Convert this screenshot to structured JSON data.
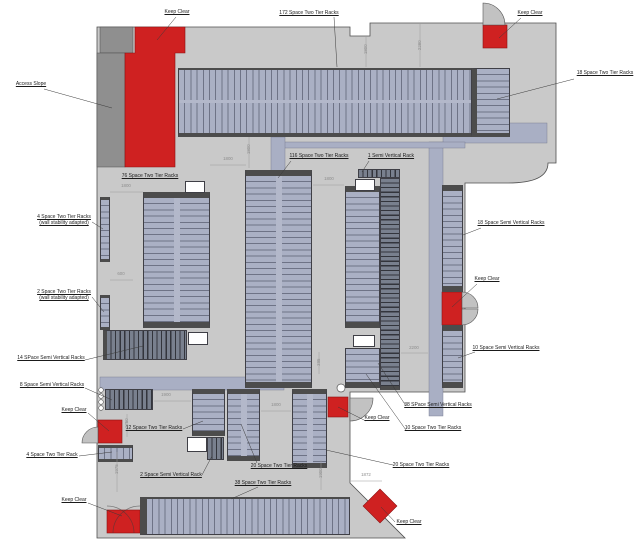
{
  "drawing_title": "",
  "colors": {
    "floor": "#c9c9c9",
    "access_slope": "#8f8f8f",
    "rack_light": "#aab0c4",
    "rack_light_line": "#6e7386",
    "rack_dark": "#79808e",
    "rack_dark_line": "#33353c",
    "rack_cap": "#4c4c4c",
    "keep_clear_red": "#cf2121",
    "outline": "#4f4f4f",
    "dimension_gray": "#8e8e8e"
  },
  "labels": [
    {
      "id": "keep-clear-top-left",
      "text": "Keep Clear",
      "x": 156,
      "y": 9,
      "w": 42,
      "leader": [
        176,
        17,
        157,
        40
      ]
    },
    {
      "id": "label-172-space-two-tier-racks",
      "text": "172 Space Two Tier Racks",
      "x": 266,
      "y": 10,
      "w": 86,
      "leader": [
        334,
        17,
        337,
        67
      ]
    },
    {
      "id": "keep-clear-top-right",
      "text": "Keep Clear",
      "x": 509,
      "y": 10,
      "w": 42,
      "leader": [
        521,
        18,
        499,
        38
      ]
    },
    {
      "id": "access-slope",
      "text": "Access Slope",
      "x": 8,
      "y": 81,
      "w": 46,
      "leader": [
        44,
        89,
        112,
        108
      ]
    },
    {
      "id": "label-18-space-two-tier-racks",
      "text": "18 Space Two Tier Racks",
      "x": 570,
      "y": 70,
      "w": 70,
      "leader": [
        574,
        79,
        497,
        99
      ]
    },
    {
      "id": "label-76-space-two-tier-racks",
      "text": "76 Space Two Tier Racks",
      "x": 118,
      "y": 173,
      "w": 64,
      "leader": null
    },
    {
      "id": "label-116-space-two-tier-racks",
      "text": "116 Space Two Tier Racks",
      "x": 286,
      "y": 153,
      "w": 66,
      "leader": [
        291,
        161,
        278,
        178
      ]
    },
    {
      "id": "label-1-semi-vertical-rack",
      "text": "1 Semi Vertical Rack",
      "x": 362,
      "y": 153,
      "w": 58,
      "leader": [
        369,
        161,
        362,
        172
      ]
    },
    {
      "id": "label-4-space-wall-adapted",
      "text": "4 Space Two Tier Racks\n(wall stability adapted)",
      "x": 36,
      "y": 214,
      "w": 56,
      "leader": [
        92,
        222,
        103,
        229
      ]
    },
    {
      "id": "label-2-space-wall-adapted",
      "text": "2 Space Two Tier Racks\n(wall stability adapted)",
      "x": 36,
      "y": 289,
      "w": 56,
      "leader": [
        92,
        297,
        104,
        312
      ]
    },
    {
      "id": "label-18-space-semi-vertical-racks",
      "text": "18 Space Semi Vertical Racks",
      "x": 476,
      "y": 220,
      "w": 70,
      "leader": [
        481,
        228,
        463,
        235
      ]
    },
    {
      "id": "keep-clear-right",
      "text": "Keep Clear",
      "x": 467,
      "y": 276,
      "w": 40,
      "leader": [
        477,
        284,
        452,
        307
      ]
    },
    {
      "id": "label-10-space-semi-vertical-racks",
      "text": "10 Space Semi Vertical Racks",
      "x": 470,
      "y": 345,
      "w": 72,
      "leader": [
        475,
        352,
        458,
        358
      ]
    },
    {
      "id": "label-14-space-semi-vertical-racks",
      "text": "14 SPace Semi Vertical Racks",
      "x": 16,
      "y": 355,
      "w": 70,
      "leader": [
        85,
        360,
        143,
        346
      ]
    },
    {
      "id": "label-8-space-semi-vertical-racks",
      "text": "8 Space Semi Vertical Racks",
      "x": 18,
      "y": 382,
      "w": 68,
      "leader": [
        85,
        388,
        112,
        400
      ]
    },
    {
      "id": "keep-clear-left",
      "text": "Keep Clear",
      "x": 56,
      "y": 407,
      "w": 36,
      "leader": [
        88,
        413,
        109,
        431
      ]
    },
    {
      "id": "label-12-space-two-tier-racks",
      "text": "12 Space Two Tier Racks",
      "x": 124,
      "y": 425,
      "w": 60,
      "leader": [
        183,
        429,
        203,
        421
      ]
    },
    {
      "id": "label-4-space-two-tier-rack",
      "text": "4 Space Two Tier Rack",
      "x": 24,
      "y": 452,
      "w": 56,
      "leader": [
        79,
        456,
        112,
        452
      ]
    },
    {
      "id": "label-2-space-semi-vertical-rack",
      "text": "2 Space Semi Vertical Rack",
      "x": 138,
      "y": 472,
      "w": 66,
      "leader": [
        202,
        475,
        212,
        456
      ]
    },
    {
      "id": "keep-clear-bottom-left",
      "text": "Keep Clear",
      "x": 56,
      "y": 497,
      "w": 36,
      "leader": [
        88,
        503,
        122,
        516
      ]
    },
    {
      "id": "label-38-space-two-tier-racks",
      "text": "38 Space Two Tier Racks",
      "x": 232,
      "y": 480,
      "w": 62,
      "leader": [
        258,
        487,
        231,
        499
      ]
    },
    {
      "id": "label-20-space-two-tier-racks-a",
      "text": "20 Space Two Tier Racks",
      "x": 249,
      "y": 463,
      "w": 60,
      "leader": [
        257,
        463,
        241,
        424
      ]
    },
    {
      "id": "label-20-space-two-tier-racks-b",
      "text": "20 Space Two Tier Racks",
      "x": 391,
      "y": 462,
      "w": 60,
      "leader": [
        393,
        465,
        326,
        450
      ]
    },
    {
      "id": "label-10-space-two-tier-racks",
      "text": "10 Space Two Tier Racks",
      "x": 402,
      "y": 425,
      "w": 62,
      "leader": [
        406,
        430,
        366,
        374
      ]
    },
    {
      "id": "label-38-space-semi-vertical-racks",
      "text": "38 SPace Semi Vertical Racks",
      "x": 402,
      "y": 402,
      "w": 72,
      "leader": [
        406,
        406,
        378,
        363
      ]
    },
    {
      "id": "keep-clear-mid",
      "text": "Keep Clear",
      "x": 359,
      "y": 415,
      "w": 36,
      "leader": [
        366,
        421,
        338,
        407
      ]
    },
    {
      "id": "keep-clear-bottom-right",
      "text": "Keep Clear",
      "x": 391,
      "y": 519,
      "w": 36,
      "leader": [
        395,
        522,
        381,
        507
      ]
    }
  ],
  "dimensions": [
    {
      "text": "1800",
      "cx": 228,
      "cy": 160,
      "rot": false,
      "line": [
        210,
        165,
        246,
        165
      ]
    },
    {
      "text": "1800",
      "cx": 249,
      "cy": 150,
      "rot": true,
      "line": [
        249,
        137,
        249,
        168
      ]
    },
    {
      "text": "1800",
      "cx": 366,
      "cy": 50,
      "rot": true,
      "line": [
        366,
        36,
        366,
        67
      ]
    },
    {
      "text": "2280",
      "cx": 420,
      "cy": 46,
      "rot": true,
      "line": [
        420,
        24,
        420,
        67
      ]
    },
    {
      "text": "1800",
      "cx": 126,
      "cy": 187,
      "rot": false,
      "line": [
        110,
        192,
        143,
        192
      ]
    },
    {
      "text": "1800",
      "cx": 329,
      "cy": 180,
      "rot": false,
      "line": [
        313,
        185,
        344,
        185
      ]
    },
    {
      "text": "600",
      "cx": 121,
      "cy": 275,
      "rot": false,
      "line": [
        110,
        280,
        133,
        280
      ]
    },
    {
      "text": "2200",
      "cx": 414,
      "cy": 349,
      "rot": false,
      "line": [
        401,
        353,
        428,
        353
      ]
    },
    {
      "text": "1900",
      "cx": 166,
      "cy": 396,
      "rot": false,
      "line": [
        154,
        401,
        191,
        401
      ]
    },
    {
      "text": "1800",
      "cx": 276,
      "cy": 406,
      "rot": false,
      "line": [
        261,
        411,
        291,
        411
      ]
    },
    {
      "text": "1750",
      "cx": 127,
      "cy": 424,
      "rot": true,
      "line": [
        127,
        414,
        127,
        437
      ]
    },
    {
      "text": "1975",
      "cx": 117,
      "cy": 470,
      "rot": true,
      "line": [
        117,
        452,
        117,
        492
      ]
    },
    {
      "text": "1872",
      "cx": 366,
      "cy": 476,
      "rot": false,
      "line": [
        351,
        481,
        382,
        481
      ]
    },
    {
      "text": "1900",
      "cx": 321,
      "cy": 474,
      "rot": true,
      "line": [
        321,
        460,
        321,
        490
      ]
    },
    {
      "text": "395",
      "cx": 319,
      "cy": 363,
      "rot": true,
      "line": [
        319,
        352,
        319,
        374
      ]
    }
  ],
  "racks": [
    {
      "id": "rack-172-space-two-tier",
      "x": 178,
      "y": 68,
      "w": 294,
      "h": 69,
      "kind": "v",
      "cap": {
        "t": 2,
        "b": 4
      },
      "div": "h"
    },
    {
      "id": "rack-18-space-two-tier",
      "x": 472,
      "y": 68,
      "w": 38,
      "h": 69,
      "kind": "h",
      "cap": {
        "l": 5,
        "b": 4
      }
    },
    {
      "id": "rack-76-space-two-tier",
      "x": 143,
      "y": 192,
      "w": 67,
      "h": 136,
      "kind": "h",
      "cap": {
        "t": 6,
        "b": 6
      },
      "div": "v"
    },
    {
      "id": "rack-4-space-wall",
      "x": 100,
      "y": 197,
      "w": 10,
      "h": 65,
      "kind": "h",
      "cap": {
        "t": 3,
        "b": 3
      }
    },
    {
      "id": "rack-2-space-wall",
      "x": 100,
      "y": 295,
      "w": 10,
      "h": 35,
      "kind": "h",
      "cap": {
        "t": 3,
        "b": 3
      }
    },
    {
      "id": "rack-14-space-semi-vertical",
      "x": 103,
      "y": 330,
      "w": 84,
      "h": 30,
      "kind": "vd",
      "cap": {
        "l": 4
      }
    },
    {
      "id": "rack-116-space-two-tier",
      "x": 245,
      "y": 170,
      "w": 67,
      "h": 218,
      "kind": "h",
      "cap": {
        "t": 6,
        "b": 6
      },
      "div": "v"
    },
    {
      "id": "rack-1-semi-vertical",
      "x": 358,
      "y": 169,
      "w": 42,
      "h": 9,
      "kind": "vd",
      "cap": {}
    },
    {
      "id": "rack-38-space-semi-vertical",
      "x": 380,
      "y": 178,
      "w": 20,
      "h": 212,
      "kind": "hd",
      "cap": {
        "b": 4
      }
    },
    {
      "id": "rack-center-two-tier",
      "x": 345,
      "y": 186,
      "w": 35,
      "h": 142,
      "kind": "h",
      "cap": {
        "t": 6,
        "b": 6
      }
    },
    {
      "id": "rack-10-space-two-tier",
      "x": 345,
      "y": 348,
      "w": 35,
      "h": 40,
      "kind": "h",
      "cap": {
        "b": 6
      }
    },
    {
      "id": "rack-18-space-semi-vertical",
      "x": 442,
      "y": 185,
      "w": 21,
      "h": 107,
      "kind": "h",
      "cap": {
        "t": 6,
        "b": 6
      }
    },
    {
      "id": "rack-10-space-semi-vertical",
      "x": 442,
      "y": 325,
      "w": 21,
      "h": 63,
      "kind": "h",
      "cap": {
        "t": 6,
        "b": 6
      }
    },
    {
      "id": "rack-8-space-semi-vertical",
      "x": 105,
      "y": 389,
      "w": 48,
      "h": 21,
      "kind": "vd",
      "cap": {}
    },
    {
      "id": "rack-12-space-two-tier",
      "x": 192,
      "y": 389,
      "w": 33,
      "h": 47,
      "kind": "h",
      "cap": {
        "t": 5,
        "b": 5
      }
    },
    {
      "id": "rack-2-space-semi-vertical",
      "x": 207,
      "y": 437,
      "w": 17,
      "h": 23,
      "kind": "vd",
      "cap": {}
    },
    {
      "id": "rack-20-space-two-tier-a",
      "x": 227,
      "y": 389,
      "w": 33,
      "h": 72,
      "kind": "h",
      "cap": {
        "t": 5,
        "b": 5
      },
      "div": "v"
    },
    {
      "id": "rack-20-space-two-tier-b",
      "x": 292,
      "y": 389,
      "w": 35,
      "h": 79,
      "kind": "h",
      "cap": {
        "t": 5,
        "b": 5
      },
      "div": "v"
    },
    {
      "id": "rack-4-space-two-tier",
      "x": 98,
      "y": 445,
      "w": 35,
      "h": 17,
      "kind": "v",
      "cap": {
        "t": 3,
        "b": 3
      }
    },
    {
      "id": "rack-38-space-two-tier",
      "x": 140,
      "y": 497,
      "w": 210,
      "h": 38,
      "kind": "v",
      "cap": {
        "l": 7,
        "t": 2
      }
    }
  ],
  "pillars": [
    {
      "x": 185,
      "y": 181,
      "w": 20,
      "h": 12
    },
    {
      "x": 355,
      "y": 179,
      "w": 20,
      "h": 12
    },
    {
      "x": 353,
      "y": 335,
      "w": 22,
      "h": 12
    },
    {
      "x": 187,
      "y": 437,
      "w": 20,
      "h": 15
    },
    {
      "x": 188,
      "y": 332,
      "w": 20,
      "h": 13
    }
  ]
}
